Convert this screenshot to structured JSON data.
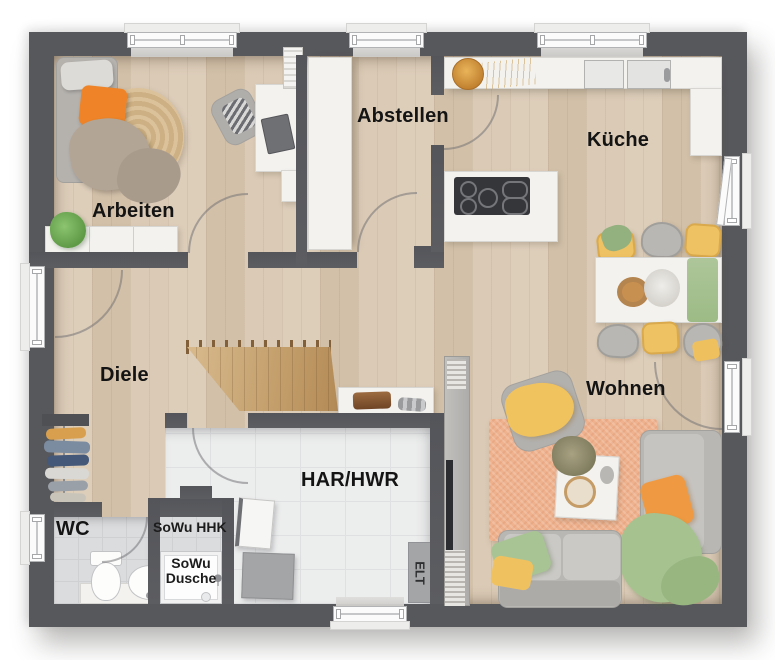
{
  "meta": {
    "type": "floor-plan"
  },
  "rooms": {
    "arbeiten": {
      "label": "Arbeiten"
    },
    "abstellen": {
      "label": "Abstellen"
    },
    "kueche": {
      "label": "Küche"
    },
    "diele": {
      "label": "Diele"
    },
    "wohnen": {
      "label": "Wohnen"
    },
    "wc": {
      "label": "WC"
    },
    "har_hwr": {
      "label": "HAR/HWR"
    },
    "sowu_hhk": {
      "label": "SoWu HHK"
    },
    "sowu_dusche": {
      "line1": "SoWu",
      "line2": "Dusche"
    },
    "elt": {
      "label": "ELT"
    }
  },
  "colors": {
    "wall": "#57585c",
    "wood_floor": "#d9c8b2",
    "tile_light": "#eceded",
    "tile_gray": "#dbdcde",
    "counter_white": "#f3f2ef",
    "accent_orange": "#ee8427",
    "accent_yellow": "#eec162",
    "accent_green": "#a6c28f",
    "rug_peach": "#efb28e"
  }
}
